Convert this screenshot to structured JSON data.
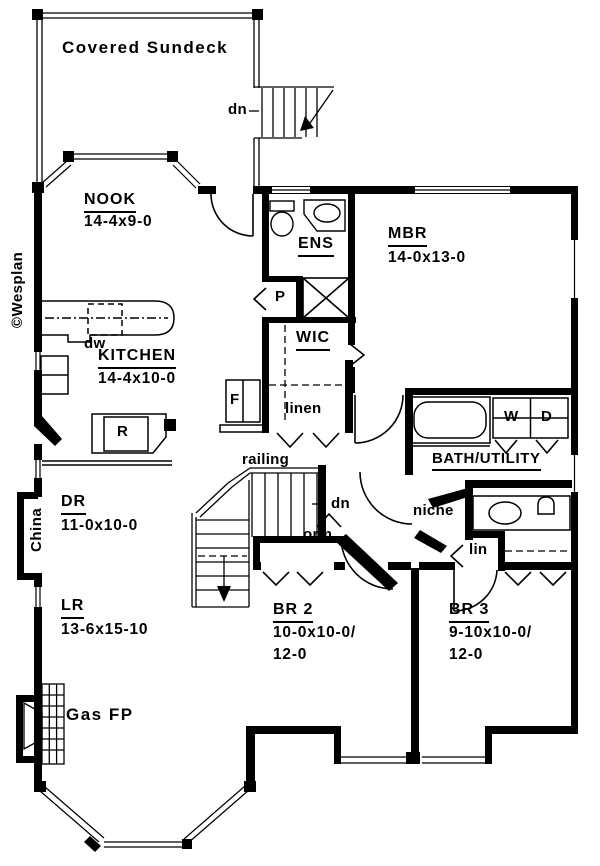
{
  "colors": {
    "ink": "#000000",
    "paper": "#ffffff"
  },
  "credit": "©Wesplan",
  "deck": {
    "label": "Covered Sundeck",
    "dn": "dn"
  },
  "rooms": {
    "nook": {
      "name": "NOOK",
      "dims": "14-4x9-0"
    },
    "ens": {
      "name": "ENS"
    },
    "mbr": {
      "name": "MBR",
      "dims": "14-0x13-0"
    },
    "wic": {
      "name": "WIC"
    },
    "kitchen": {
      "name": "KITCHEN",
      "dims": "14-4x10-0"
    },
    "bath": {
      "name": "BATH/UTILITY"
    },
    "dr": {
      "name": "DR",
      "dims": "11-0x10-0"
    },
    "lr": {
      "name": "LR",
      "dims": "13-6x15-10"
    },
    "br2": {
      "name": "BR 2",
      "dims1": "10-0x10-0/",
      "dims2": "12-0"
    },
    "br3": {
      "name": "BR 3",
      "dims1": "9-10x10-0/",
      "dims2": "12-0"
    }
  },
  "labels": {
    "dn_stairs": "dn",
    "dw": "dw",
    "pantry": "P",
    "fridge": "F",
    "range": "R",
    "linen": "linen",
    "railing": "railing",
    "niche": "niche",
    "lin": "lin",
    "dorm": "orm",
    "gas_fireplace": "Gas FP",
    "china": "China",
    "washer": "W",
    "dryer": "D"
  }
}
